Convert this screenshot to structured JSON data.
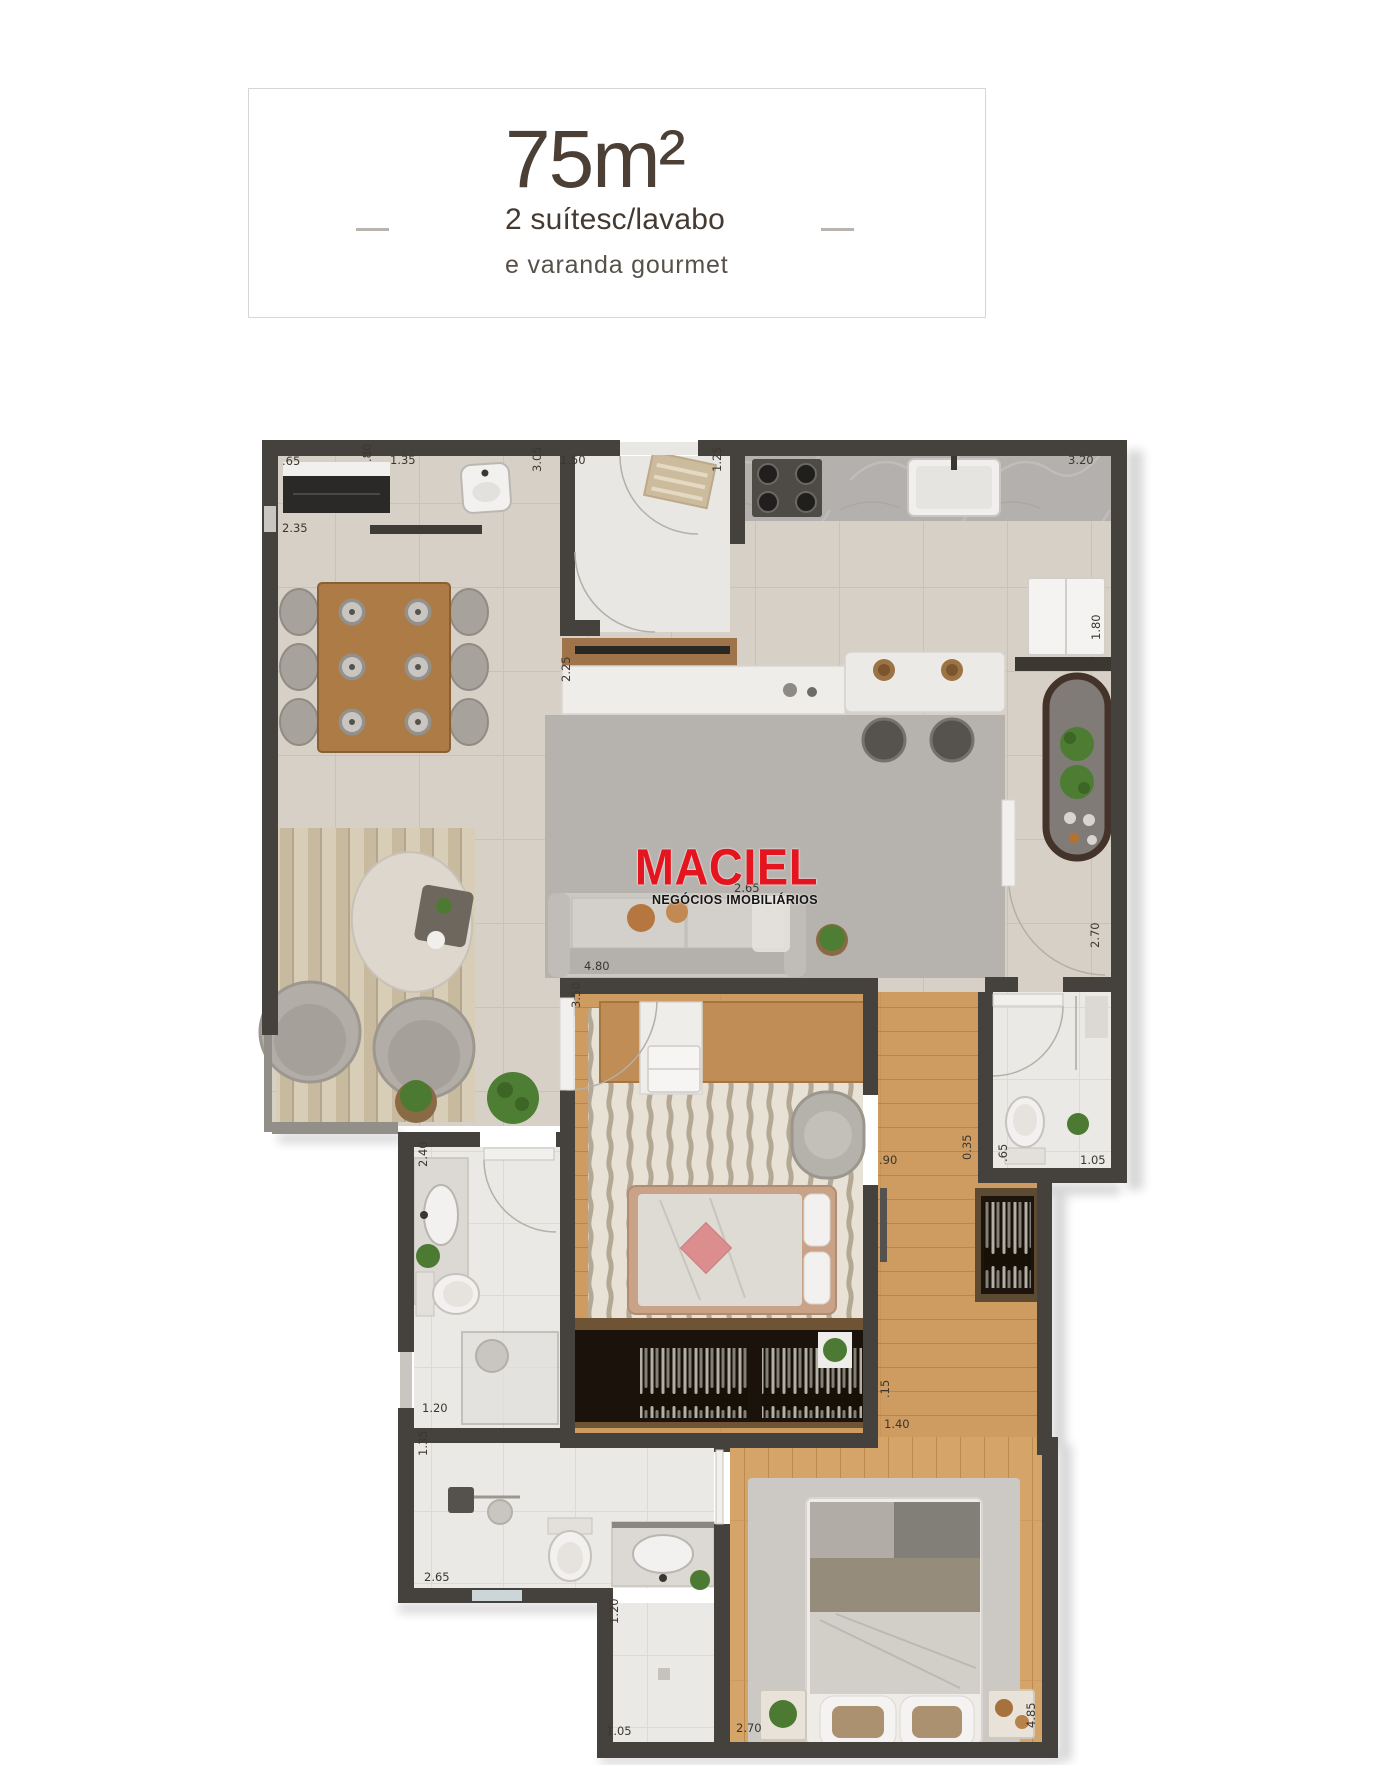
{
  "header": {
    "area": "75m²",
    "line1": "2 suítesc/lavabo",
    "line2": "e varanda gourmet"
  },
  "logo": {
    "brand": "MACIEL",
    "tagline": "NEGÓCIOS IMOBILIÁRIOS",
    "color": "#e4151f"
  },
  "dims": [
    ".65",
    ".80",
    "1.35",
    "3.05",
    "1.50",
    "1.25",
    "3.20",
    "2.35",
    "1.80",
    "2.25",
    "2.65",
    "2.70",
    "4.80",
    "3.50",
    "2.40",
    ".90",
    "0.35",
    ".65",
    "1.05",
    ".15",
    "1.40",
    "1.20",
    "1.35",
    "2.65",
    "1.20",
    "1.05",
    "2.70",
    "4.85"
  ],
  "palette": {
    "logo_red": "#e4151f",
    "wall": "#45413c",
    "floor_tile": "#d7d0c7",
    "floor_wood": "#cf9d62",
    "floor_bath": "#ebe9e6",
    "marble": "#b2afac",
    "rug_gray": "#b6b2ad",
    "accent_pink": "#dc8d8d",
    "plant_green": "#4c7a32",
    "header_text": "#4c4036",
    "dim_text": "#3b372f"
  }
}
